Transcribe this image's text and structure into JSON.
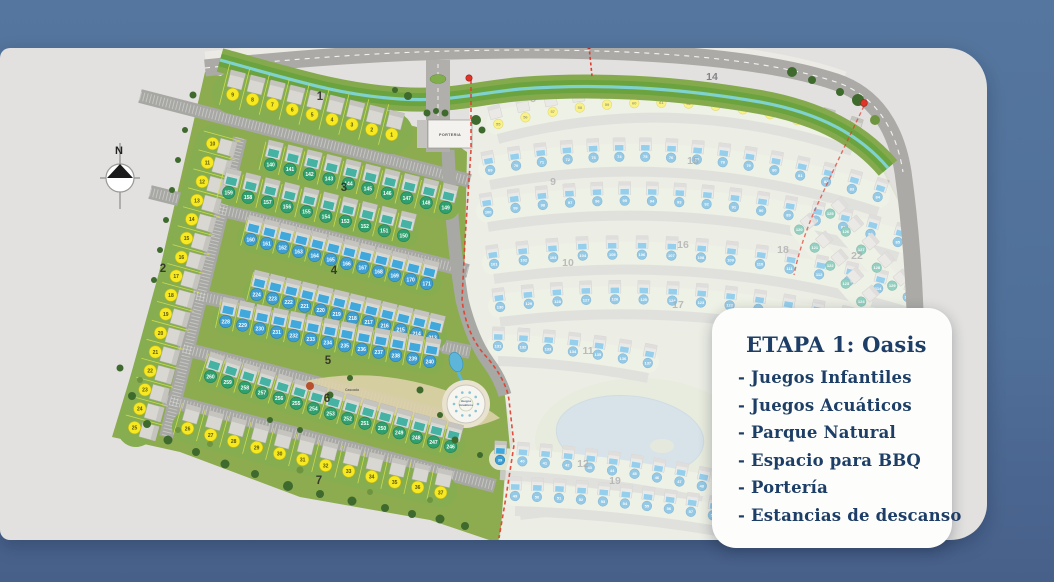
{
  "info_card": {
    "title": "ETAPA 1: Oasis",
    "bullet_prefix": "- ",
    "items": [
      "Juegos Infantiles",
      "Juegos Acuáticos",
      "Parque Natural",
      "Espacio para BBQ",
      "Portería",
      "Estancias de descanso"
    ]
  },
  "compass": {
    "label": "N"
  },
  "palette": {
    "bg_top": "#55769e",
    "bg_bottom": "#47608a",
    "card_gray": "#e2e1df",
    "phase1_green": "#8cac4f",
    "band_green": "#86ad50",
    "road_gray": "#abaaa6",
    "canal_teal": "#7fd2cd",
    "canal_bank": "#6ba33f",
    "phase2_base": "#dde1d0",
    "wash_white": "#ffffff",
    "red_boundary": "#e23b2e",
    "lake_blue": "#b9cdd8",
    "sand": "#ddd2a8",
    "info_text": "#1d3e66",
    "pools": {
      "bluepool": "#41a8dc",
      "tealpool": "#45b2a4"
    },
    "circle_styles": {
      "yellow": {
        "fill": "#f6e821",
        "stroke": "#c9ba14",
        "text": "#5a5407"
      },
      "green": {
        "fill": "#2f9f6d",
        "stroke": "#23805a",
        "text": "#ffffff"
      },
      "blue": {
        "fill": "#3e9ed2",
        "stroke": "#2d7fb0",
        "text": "#ffffff"
      },
      "teal": {
        "fill": "#3aa98f",
        "stroke": "#2a8870",
        "text": "#ffffff"
      }
    }
  },
  "site_plan": {
    "entrance_label": "PORTERIA",
    "plaza_label": [
      "Juegos",
      "Acuáticos"
    ],
    "park_label": "Cascada",
    "phase1_block_labels": [
      {
        "label": "1",
        "x": 320,
        "y": 100
      },
      {
        "label": "2",
        "x": 163,
        "y": 272
      },
      {
        "label": "3",
        "x": 344,
        "y": 191
      },
      {
        "label": "4",
        "x": 334,
        "y": 274
      },
      {
        "label": "5",
        "x": 328,
        "y": 364
      },
      {
        "label": "6",
        "x": 327,
        "y": 402
      },
      {
        "label": "7",
        "x": 319,
        "y": 484
      }
    ],
    "phase2_block_labels": [
      {
        "label": "8",
        "x": 533,
        "y": 102
      },
      {
        "label": "14",
        "x": 712,
        "y": 80
      },
      {
        "label": "9",
        "x": 553,
        "y": 185
      },
      {
        "label": "15",
        "x": 693,
        "y": 164
      },
      {
        "label": "16",
        "x": 683,
        "y": 248
      },
      {
        "label": "10",
        "x": 568,
        "y": 266
      },
      {
        "label": "17",
        "x": 678,
        "y": 308
      },
      {
        "label": "18",
        "x": 783,
        "y": 253
      },
      {
        "label": "11",
        "x": 588,
        "y": 354
      },
      {
        "label": "22",
        "x": 857,
        "y": 259
      },
      {
        "label": "12",
        "x": 583,
        "y": 467
      },
      {
        "label": "19",
        "x": 615,
        "y": 484
      }
    ],
    "rows": [
      {
        "block": "1",
        "phase": 1,
        "circle": "yellow",
        "pool": null,
        "from": 9,
        "to": 1,
        "p0": [
          233,
          93
        ],
        "p1": [
          392,
          133
        ],
        "sag": 0,
        "bw": 42
      },
      {
        "block": "2",
        "phase": 1,
        "circle": "yellow",
        "pool": null,
        "from": 10,
        "to": 25,
        "p0": [
          214,
          144
        ],
        "p1": [
          136,
          428
        ],
        "sag": 0,
        "bw": 38
      },
      {
        "block": "3",
        "phase": 1,
        "circle": "green",
        "pool": "tealpool",
        "from": 140,
        "to": 149,
        "p0": [
          271,
          163
        ],
        "p1": [
          446,
          206
        ],
        "sag": 0,
        "bw": 28
      },
      {
        "block": "3",
        "phase": 1,
        "circle": "green",
        "pool": "tealpool",
        "from": 159,
        "to": 150,
        "p0": [
          229,
          191
        ],
        "p1": [
          404,
          234
        ],
        "sag": 0,
        "bw": 28
      },
      {
        "block": "4",
        "phase": 1,
        "circle": "blue",
        "pool": "bluepool",
        "from": 160,
        "to": 171,
        "p0": [
          251,
          238
        ],
        "p1": [
          427,
          282
        ],
        "sag": 0,
        "bw": 28
      },
      {
        "block": "4",
        "phase": 1,
        "circle": "blue",
        "pool": "bluepool",
        "from": 224,
        "to": 213,
        "p0": [
          257,
          293
        ],
        "p1": [
          433,
          336
        ],
        "sag": 0,
        "bw": 28
      },
      {
        "block": "5",
        "phase": 1,
        "circle": "blue",
        "pool": "bluepool",
        "from": 228,
        "to": 240,
        "p0": [
          226,
          320
        ],
        "p1": [
          430,
          360
        ],
        "sag": 2,
        "bw": 28
      },
      {
        "block": "6",
        "phase": 1,
        "circle": "green",
        "pool": "tealpool",
        "from": 260,
        "to": 246,
        "p0": [
          211,
          375
        ],
        "p1": [
          451,
          445
        ],
        "sag": 4,
        "bw": 28
      },
      {
        "block": "7",
        "phase": 1,
        "circle": "yellow",
        "pool": null,
        "from": 26,
        "to": 37,
        "p0": [
          188,
          427
        ],
        "p1": [
          441,
          491
        ],
        "sag": 4,
        "bw": 32
      },
      {
        "block": "8",
        "phase": 2,
        "circle": "yellow",
        "pool": null,
        "from": 55,
        "to": 68,
        "p0": [
          498,
          123
        ],
        "p1": [
          852,
          135
        ],
        "sag": -54,
        "bw": 24
      },
      {
        "block": "9",
        "phase": 2,
        "circle": "blue",
        "pool": "bluepool",
        "from": 69,
        "to": 84,
        "p0": [
          490,
          169
        ],
        "p1": [
          878,
          196
        ],
        "sag": -50,
        "bw": 24
      },
      {
        "block": "9",
        "phase": 2,
        "circle": "blue",
        "pool": "bluepool",
        "from": 100,
        "to": 85,
        "p0": [
          488,
          211
        ],
        "p1": [
          898,
          241
        ],
        "sag": -48,
        "bw": 24
      },
      {
        "block": "10",
        "phase": 2,
        "circle": "blue",
        "pool": "bluepool",
        "from": 101,
        "to": 115,
        "p0": [
          494,
          263
        ],
        "p1": [
          908,
          296
        ],
        "sag": -46,
        "bw": 24
      },
      {
        "block": "10",
        "phase": 2,
        "circle": "blue",
        "pool": "bluepool",
        "from": 130,
        "to": 116,
        "p0": [
          500,
          306
        ],
        "p1": [
          902,
          339
        ],
        "sag": -42,
        "bw": 24
      },
      {
        "block": "11",
        "phase": 2,
        "circle": "blue",
        "pool": "bluepool",
        "from": 131,
        "to": 137,
        "p0": [
          498,
          345
        ],
        "p1": [
          648,
          362
        ],
        "sag": -6,
        "bw": 22
      },
      {
        "block": "12",
        "phase": 2,
        "circle": "blue",
        "pool": "bluepool",
        "from": 39,
        "to": 48,
        "p0": [
          500,
          459
        ],
        "p1": [
          702,
          485
        ],
        "sag": -8,
        "bw": 22
      },
      {
        "block": "12",
        "phase": 2,
        "circle": "blue",
        "pool": "bluepool",
        "from": 49,
        "to": 59,
        "p0": [
          515,
          495
        ],
        "p1": [
          735,
          518
        ],
        "sag": -8,
        "bw": 22
      },
      {
        "block": "22",
        "phase": 2,
        "circle": "teal",
        "pool": null,
        "from": 120,
        "to": 124,
        "p0": [
          800,
          229
        ],
        "p1": [
          862,
          301
        ],
        "sag": 0,
        "bw": 20,
        "noroad": true
      },
      {
        "block": "22",
        "phase": 2,
        "circle": "teal",
        "pool": null,
        "from": 125,
        "to": 129,
        "p0": [
          831,
          213
        ],
        "p1": [
          893,
          285
        ],
        "sag": 0,
        "bw": 20,
        "noroad": true
      }
    ]
  }
}
